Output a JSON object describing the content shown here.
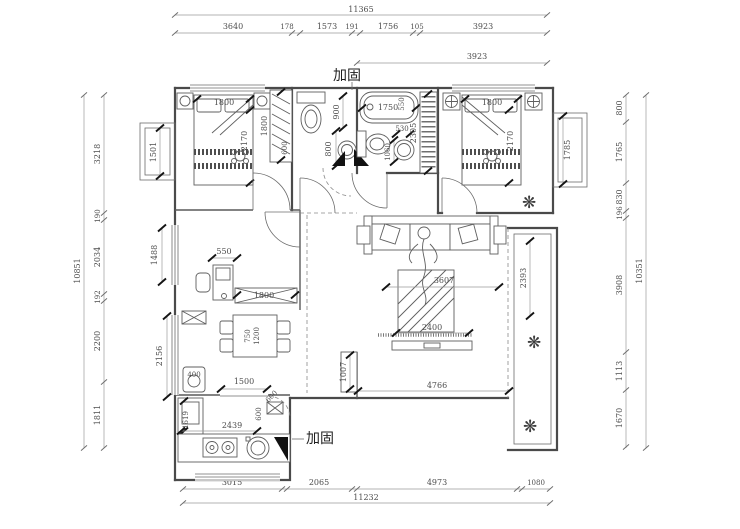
{
  "labels": {
    "reinforce_top": "加固",
    "reinforce_bottom": "加固"
  },
  "icons": {
    "plant": "❋"
  },
  "dims": {
    "top_total": "11365",
    "top": [
      "3640",
      "178",
      "1573",
      "191",
      "1756",
      "105",
      "3923"
    ],
    "top_inner": "3923",
    "bottom": [
      "3015",
      "2065",
      "4973",
      "1080"
    ],
    "bottom_total": "11232",
    "left_total": "10851",
    "left": [
      "3218",
      "190",
      "2034",
      "192",
      "2200",
      "1811"
    ],
    "right": [
      "800",
      "1765",
      "830",
      "196",
      "3908",
      "1113",
      "1670"
    ],
    "right_total": "10351",
    "windows_left": {
      "bay": "1501",
      "study": "1488",
      "kitchen": "2156"
    },
    "bedroom1": {
      "bed_width": "1800",
      "bed_depth": "2170",
      "wardrobe_length": "1800",
      "wardrobe_depth": "600"
    },
    "hall": {
      "wc_width": "900",
      "basin": "800"
    },
    "bath": {
      "tub_length": "1750",
      "tub_width": "550",
      "vanity": "530",
      "basin_width": "1060",
      "shelf": "2305"
    },
    "bedroom2": {
      "bed_width": "1800",
      "bed_depth": "2170",
      "bay": "1785"
    },
    "study": {
      "desk": "550",
      "cabinet": "1800"
    },
    "dining": {
      "table_width": "750",
      "table_length": "1200"
    },
    "living": {
      "width": "3607",
      "tv_wall": "2400",
      "pier": "1007",
      "south": "4766",
      "balcony": "2393"
    },
    "kitchen": {
      "pass": "1500",
      "counter": "2439",
      "left_counter": "1619",
      "flue": "600",
      "door": "600",
      "niche": "400"
    }
  }
}
